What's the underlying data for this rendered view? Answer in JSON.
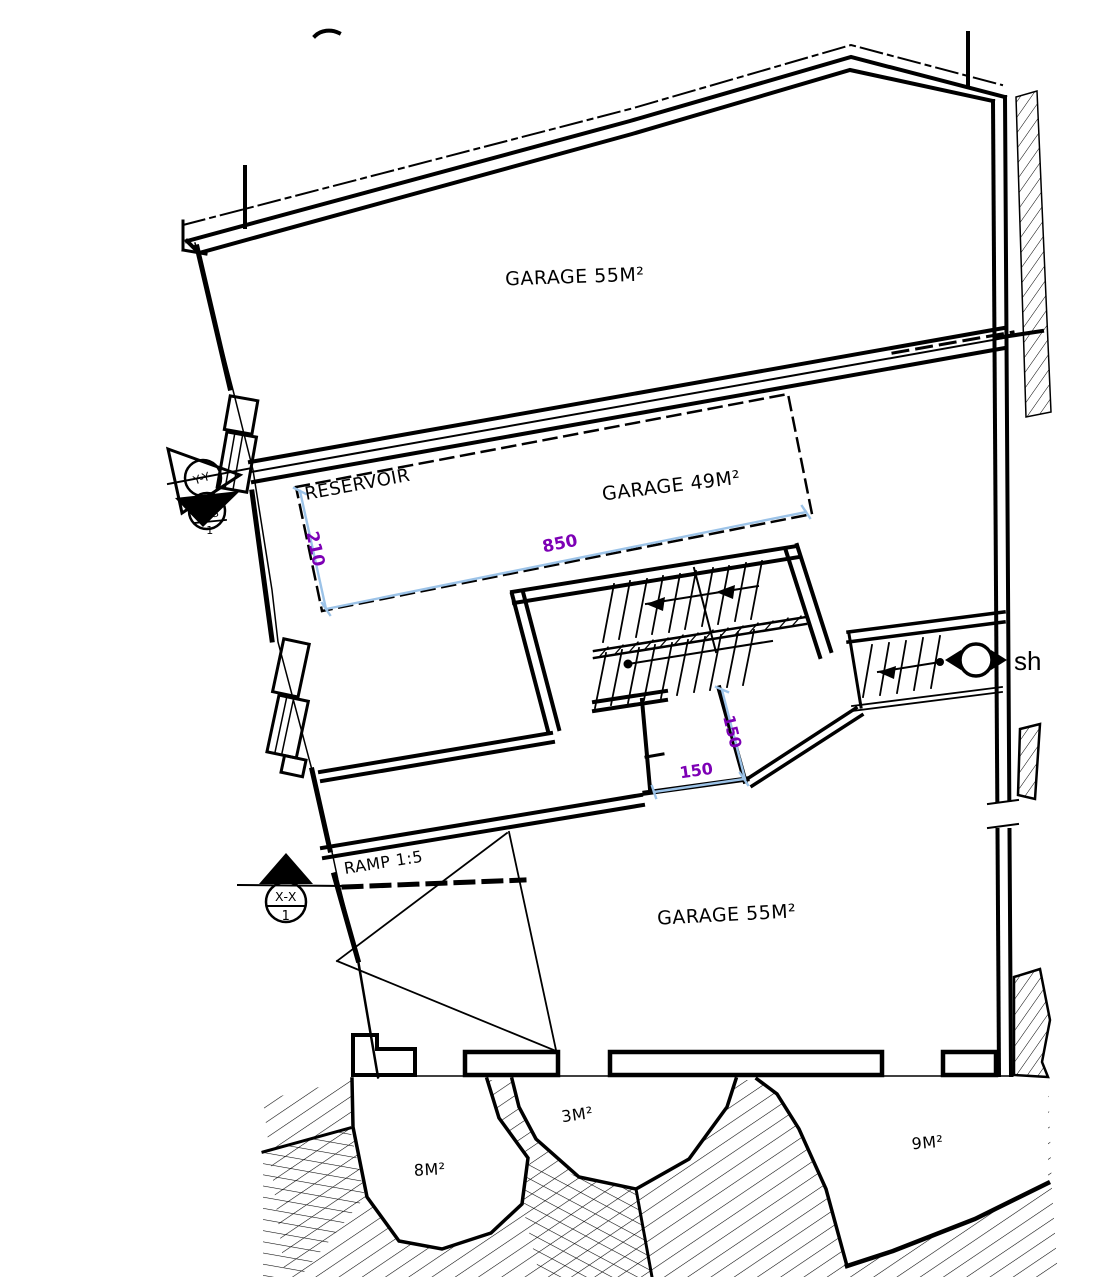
{
  "colors": {
    "line": "#000000",
    "background": "#ffffff",
    "dimension_line": "#9cc3e8",
    "dimension_text": "#7d00b5"
  },
  "plan": {
    "rooms": {
      "garage_top": "GARAGE 55M²",
      "garage_middle": "GARAGE 49M²",
      "reservoir": "RESERVOIR",
      "garage_bottom": "GARAGE 55M²"
    },
    "areas": {
      "area_8": "8M²",
      "area_3": "3M²",
      "area_9": "9M²"
    },
    "dimensions": {
      "reservoir_length": "850",
      "reservoir_width": "210",
      "shaft_height": "150",
      "shaft_width": "150"
    },
    "annotations": {
      "ramp": "RAMP 1:5",
      "shaft_label": "sh"
    },
    "section_markers": {
      "marker_yy": "Y-Y",
      "marker_ss": "S-S",
      "marker_ss_number": "1",
      "marker_xx": "X-X",
      "marker_xx_number": "1"
    }
  }
}
